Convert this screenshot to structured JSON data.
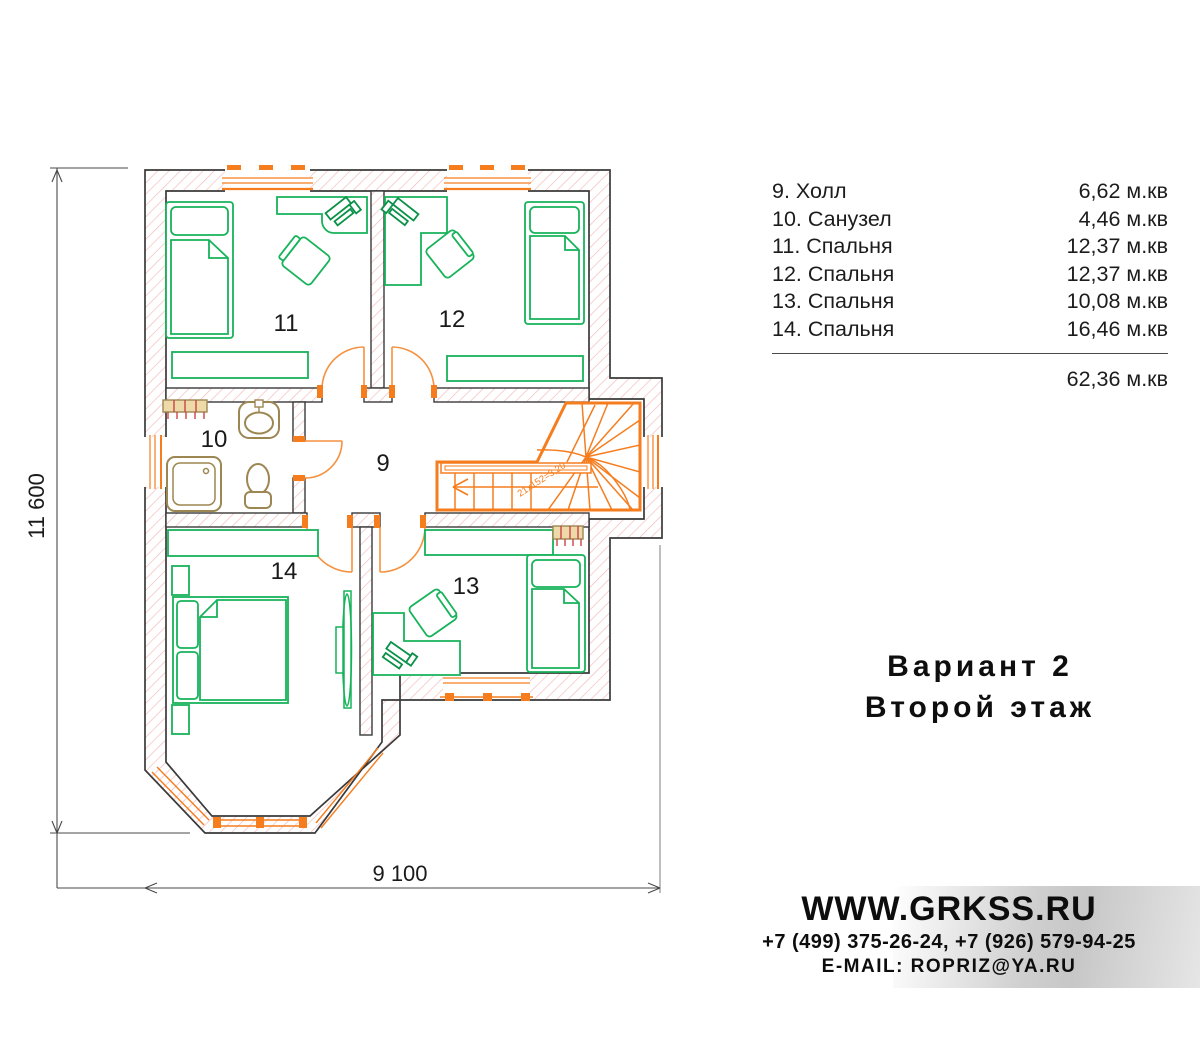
{
  "plan": {
    "labels": {
      "hall": "9",
      "bath": "10",
      "b11": "11",
      "b12": "12",
      "b13": "13",
      "b14": "14"
    },
    "dim_height": "11 600",
    "dim_width": "9 100",
    "stair_note": "21x152=3,20"
  },
  "legend": {
    "rows": [
      {
        "name": "9. Холл",
        "area": "6,62 м.кв"
      },
      {
        "name": "10. Санузел",
        "area": "4,46 м.кв"
      },
      {
        "name": "11. Спальня",
        "area": "12,37 м.кв"
      },
      {
        "name": "12. Спальня",
        "area": "12,37 м.кв"
      },
      {
        "name": "13. Спальня",
        "area": "10,08 м.кв"
      },
      {
        "name": "14. Спальня",
        "area": "16,46 м.кв"
      }
    ],
    "total": "62,36 м.кв"
  },
  "title": {
    "line1": "Вариант 2",
    "line2": "Второй этаж"
  },
  "contact": {
    "website": "WWW.GRKSS.RU",
    "phones": "+7 (499) 375-26-24, +7 (926) 579-94-25",
    "email": "E-MAIL: ROPRIZ@YA.RU"
  },
  "colors": {
    "accent_orange": "#f57d1e",
    "furniture_green": "#17b35a",
    "computer_green": "#0a9148",
    "fixture_tan": "#9c8752",
    "radiator_red": "#cc4444",
    "wall_hatch_pink": "#f2b9b9",
    "wall_stroke": "#3a3a3a"
  }
}
